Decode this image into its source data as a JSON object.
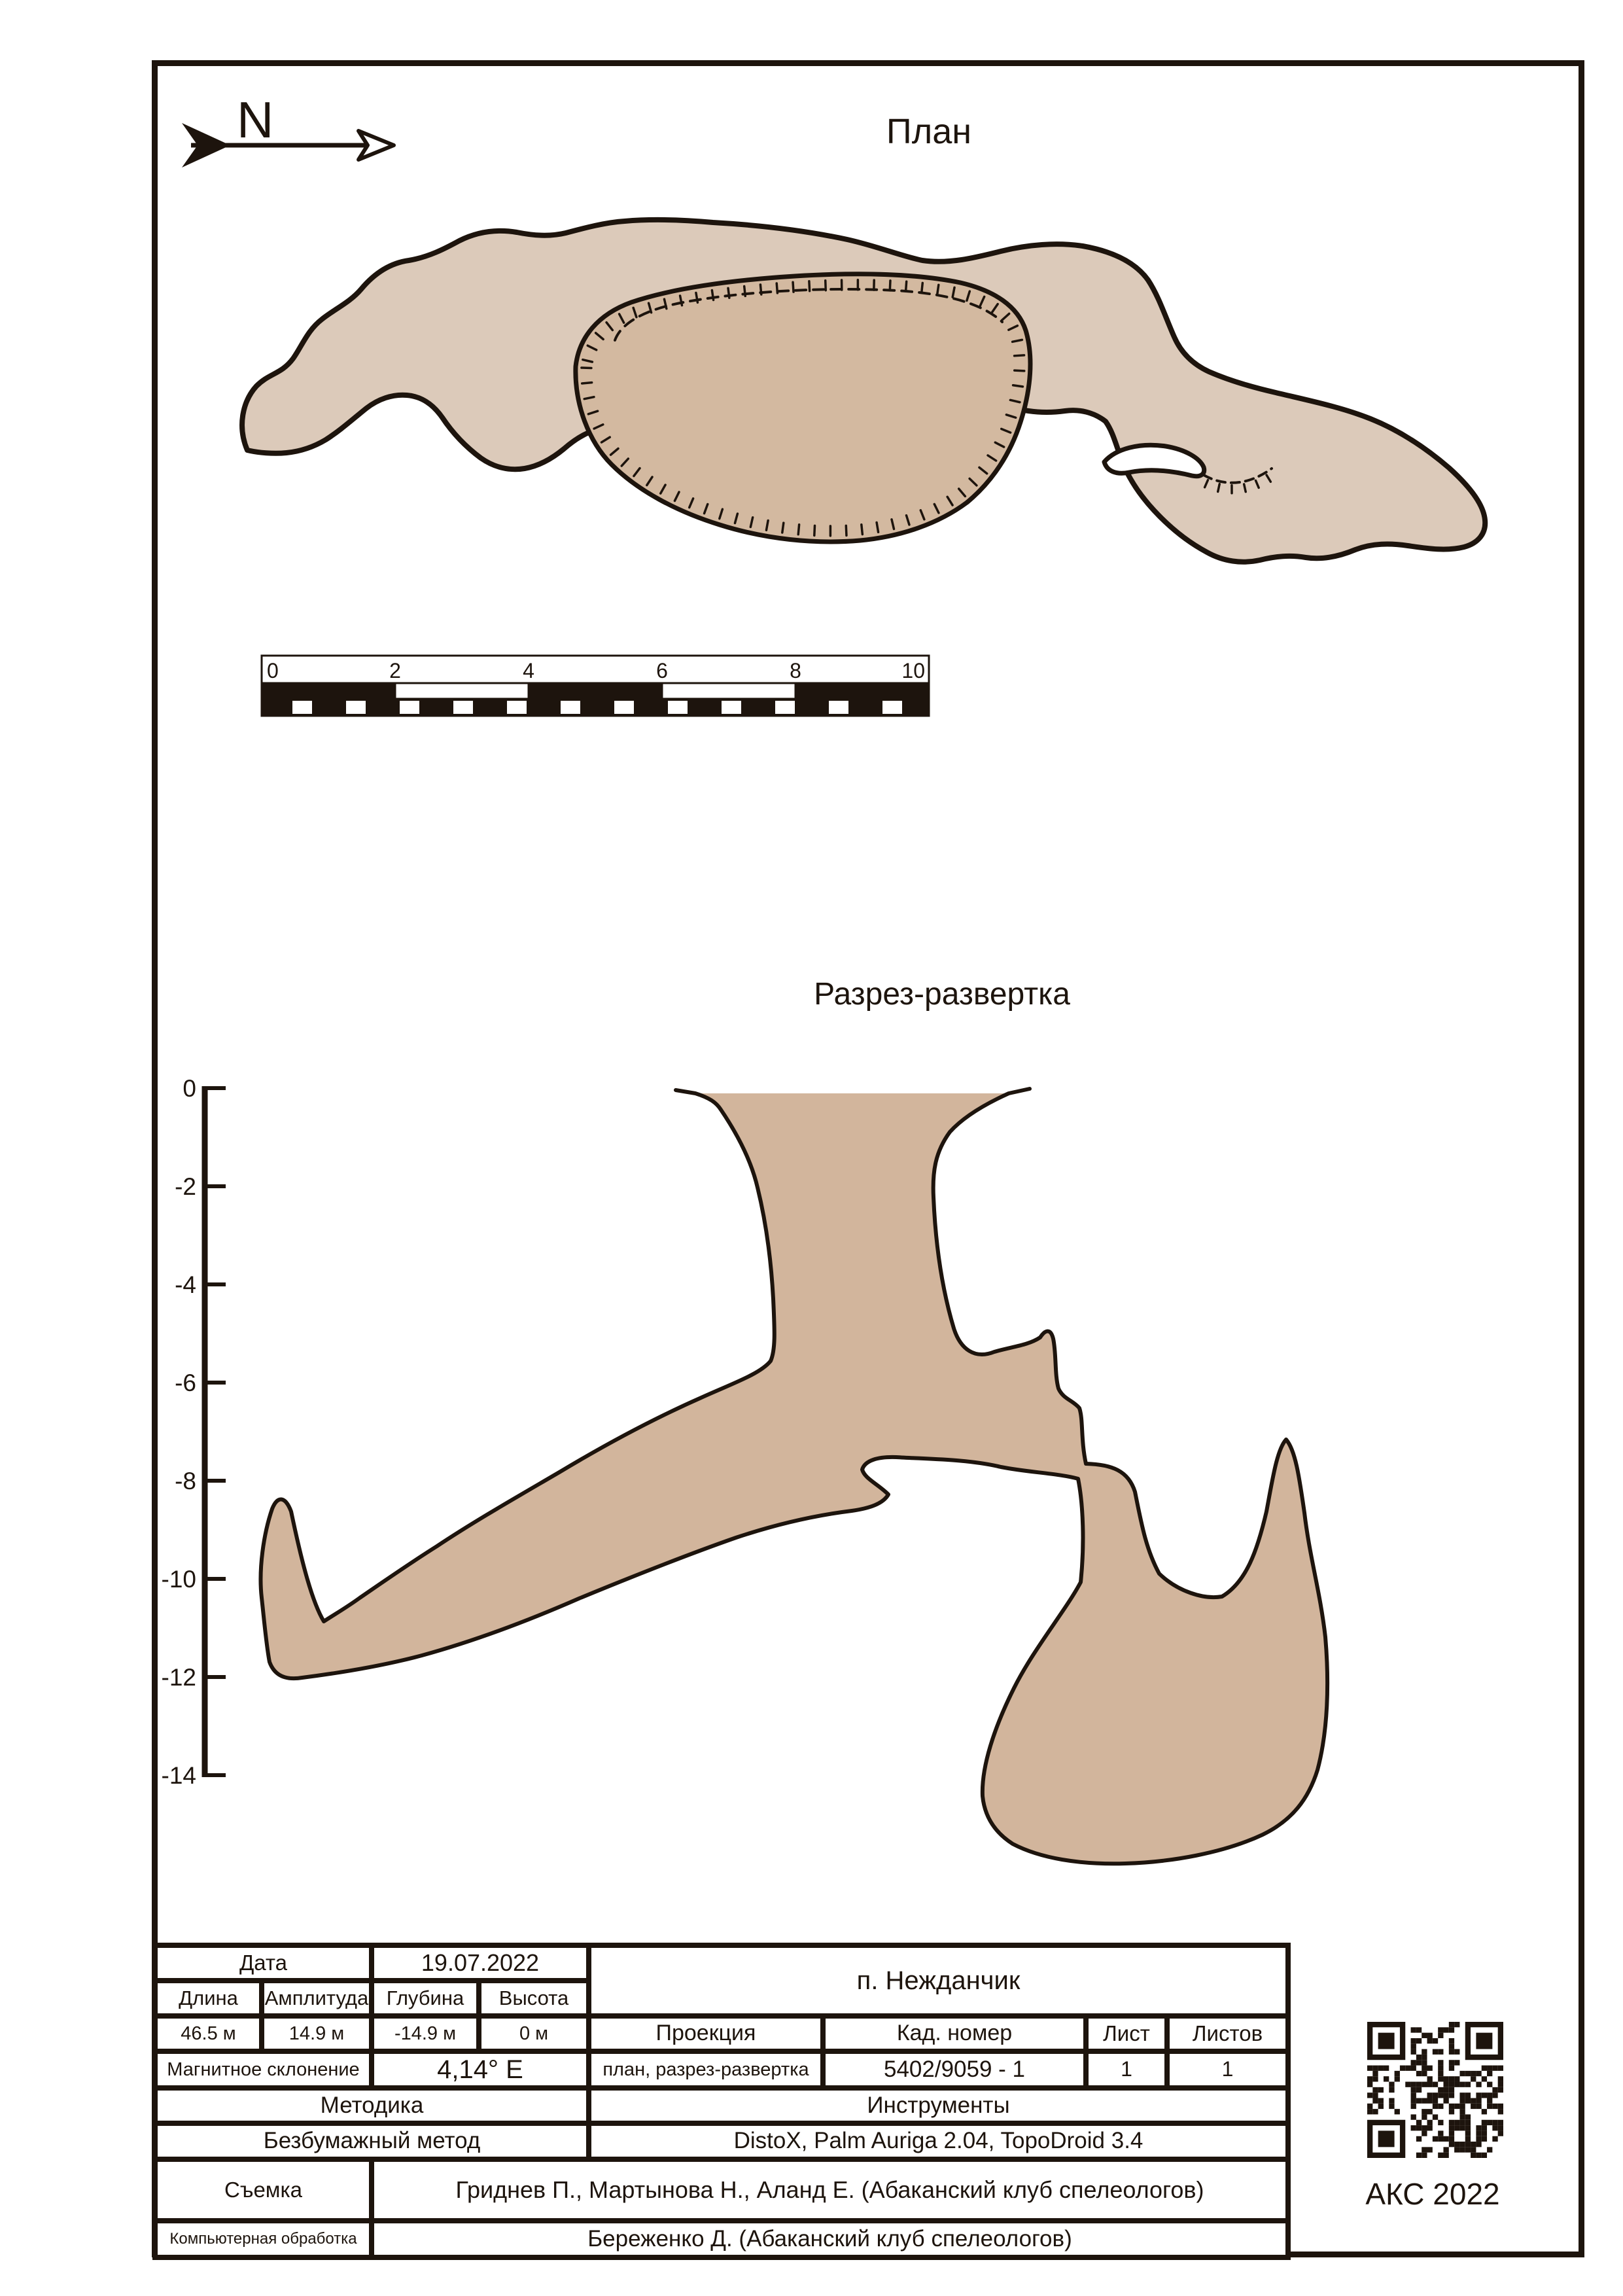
{
  "page": {
    "plan_title": "План",
    "section_title": "Разрез-развертка",
    "north_label": "N",
    "credit": "АКС 2022"
  },
  "colors": {
    "ink": "#1d140d",
    "plan_fill": "#dccaba",
    "pit_fill": "#d3b9a0",
    "section_fill": "#d2b59c"
  },
  "scale_bar": {
    "unit_labels": [
      "0",
      "2",
      "4",
      "6",
      "8",
      "10"
    ]
  },
  "depth_axis": {
    "labels": [
      "0",
      "-2",
      "-4",
      "-6",
      "-8",
      "-10",
      "-12",
      "-14"
    ]
  },
  "info_table": {
    "date_label": "Дата",
    "date_value": "19.07.2022",
    "cave_name": "п. Нежданчик",
    "length_label": "Длина",
    "amplitude_label": "Амплитуда",
    "depth_label": "Глубина",
    "height_label": "Высота",
    "length_value": "46.5 м",
    "amplitude_value": "14.9 м",
    "depth_value": "-14.9 м",
    "height_value": "0 м",
    "declination_label": "Магнитное склонение",
    "declination_value": "4,14° E",
    "projection_label": "Проекция",
    "projection_value": "план, разрез-развертка",
    "cad_number_label": "Кад. номер",
    "cad_number_value": "5402/9059 - 1",
    "sheet_label": "Лист",
    "sheet_value": "1",
    "sheets_label": "Листов",
    "sheets_value": "1",
    "method_label": "Методика",
    "method_value": "Безбумажный метод",
    "instruments_label": "Инструменты",
    "instruments_value": "DistoX, Palm Auriga 2.04, TopoDroid 3.4",
    "survey_label": "Съемка",
    "survey_value": "Гриднев П., Мартынова Н., Аланд Е.  (Абаканский клуб спелеологов)",
    "processing_label": "Компьютерная обработка",
    "processing_value": "Береженко Д. (Абаканский клуб спелеологов)"
  }
}
